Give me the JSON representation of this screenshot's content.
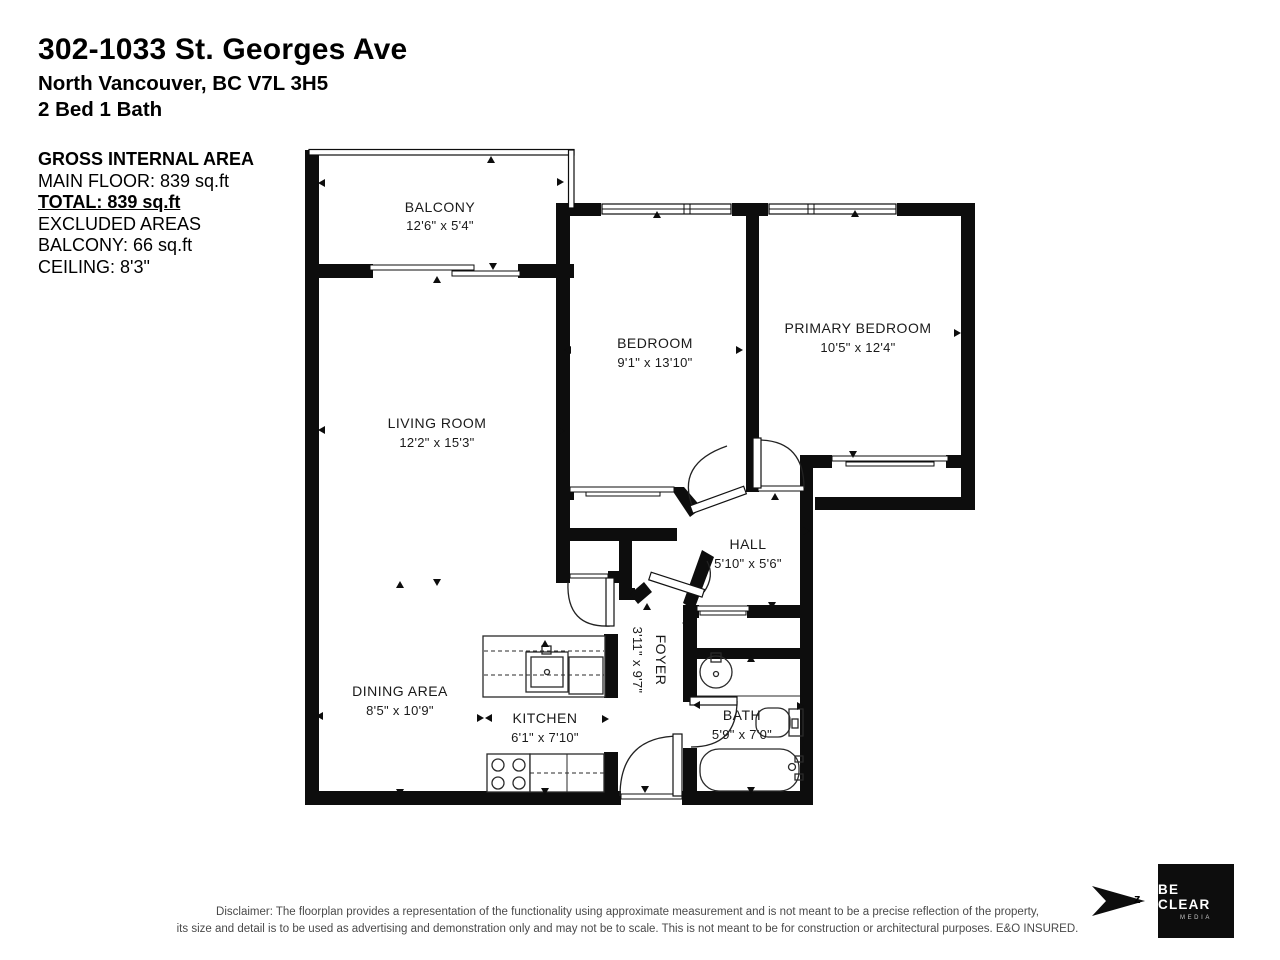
{
  "header": {
    "title": "302-1033 St. Georges Ave",
    "address": "North Vancouver, BC V7L 3H5",
    "beds_baths": "2 Bed 1 Bath"
  },
  "area_summary": {
    "heading": "GROSS INTERNAL AREA",
    "main_floor": "MAIN FLOOR: 839 sq.ft",
    "total": "TOTAL: 839 sq.ft",
    "excluded_heading": "EXCLUDED AREAS",
    "balcony": "BALCONY: 66 sq.ft",
    "ceiling": "CEILING: 8'3\""
  },
  "rooms": [
    {
      "name": "BALCONY",
      "dims": "12'6\" x 5'4\""
    },
    {
      "name": "BEDROOM",
      "dims": "9'1\" x 13'10\""
    },
    {
      "name": "PRIMARY BEDROOM",
      "dims": "10'5\" x 12'4\""
    },
    {
      "name": "LIVING ROOM",
      "dims": "12'2\" x 15'3\""
    },
    {
      "name": "HALL",
      "dims": "5'10\" x 5'6\""
    },
    {
      "name": "DINING AREA",
      "dims": "8'5\" x 10'9\""
    },
    {
      "name": "KITCHEN",
      "dims": "6'1\" x 7'10\""
    },
    {
      "name": "FOYER",
      "dims": "3'11\" x 9'7\""
    },
    {
      "name": "BATH",
      "dims": "5'9\" x 7'0\""
    }
  ],
  "footer": {
    "disclaimer_line1": "Disclaimer: The floorplan provides a representation of the functionality using approximate measurement and is not meant to be a precise reflection of the property,",
    "disclaimer_line2": "its size and detail is to be used as advertising and demonstration only and may not be to scale. This is not meant to be for construction or architectural purposes. E&O INSURED."
  },
  "logo": {
    "brand_line1": "BE CLEAR",
    "brand_line2": "MEDIA",
    "north_label": "z"
  },
  "colors": {
    "wall": "#0d0d0d",
    "text": "#1a1a1a",
    "disclaimer": "#4a4a4a"
  }
}
